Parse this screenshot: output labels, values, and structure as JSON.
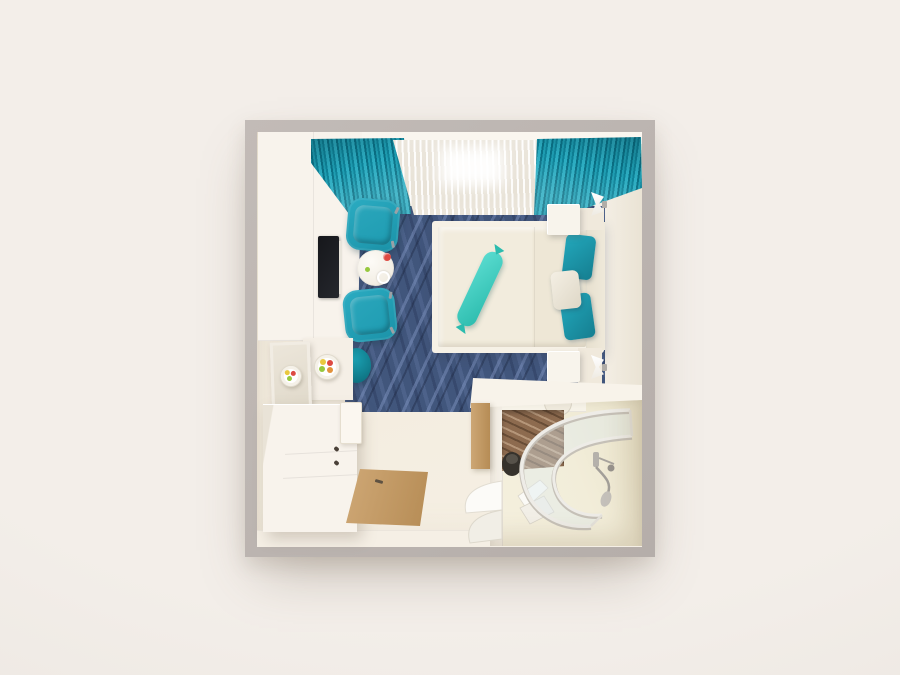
{
  "scene": {
    "type": "3d-interior-render",
    "view": "top-down floor plan",
    "subject": "hotel cabin bedroom with en-suite shower bathroom",
    "text_content": "none"
  },
  "palette": {
    "page-bg": "#f1ece7",
    "wall-outer": "#b5aeaa",
    "wall-outer-light": "#c2bbb7",
    "wall-face": "#eae3d4",
    "pelmet": "#faf6ef",
    "floor": "#f0e9db",
    "floor-light": "#f6f0e4",
    "carpet-base": "#41567c",
    "curtain": "#1e9db2",
    "curtain-dark": "#0a7186",
    "curtain-light": "#2cadc2",
    "sheer": "#f6f2ea",
    "chair": "#2bacc2",
    "chair-deep": "#1b92a8",
    "stool": "#0e7382",
    "stool-light": "#1ba2b4",
    "table": "#f1ece1",
    "bed-base": "#f6f1e6",
    "duvet": "#f2ecdd",
    "headboard": "#efe9da",
    "bolster": "#2cbcae",
    "bolster-light": "#5adcd0",
    "pillow-teal": "#23a9bd",
    "pillow-teal-dark": "#157e90",
    "nightstand": "#f8f4ec",
    "unit-white": "#f8f3ec",
    "tv": "#25272d",
    "knob": "#4a4038",
    "wood": "#cfa876",
    "wood-deep": "#b68c55",
    "bath-wall": "#f2edd9",
    "marble": "#8d6b4f",
    "vanity": "#f8f3ea",
    "metal": "#a8a49e",
    "fruit-red": "#dd4a42",
    "fruit-yellow": "#e9c83e",
    "fruit-green": "#97c83e",
    "fruit-orange": "#e2923b"
  },
  "objects": [
    {
      "name": "room-shell",
      "desc": "square room with thick gray walls viewed from directly above"
    },
    {
      "name": "window-wall",
      "desc": "top wall with white sheer curtain center and teal drapes both sides"
    },
    {
      "name": "wavy-carpet",
      "desc": "navy blue carpet with wavy stripe pattern"
    },
    {
      "name": "wardrobe-desk-unit",
      "desc": "white full-height unit along left wall with TV"
    },
    {
      "name": "tv",
      "desc": "black flat screen on desk"
    },
    {
      "name": "armchair-top",
      "desc": "teal armchair"
    },
    {
      "name": "armchair-bottom",
      "desc": "teal armchair"
    },
    {
      "name": "round-table",
      "items": [
        "red berry dish",
        "white ring",
        "green olive"
      ]
    },
    {
      "name": "teal-stool",
      "desc": "round teal ottoman at carpet edge"
    },
    {
      "name": "leaning-mirror",
      "desc": "framed mirror reflecting fruit plate"
    },
    {
      "name": "fruit-plate",
      "desc": "white plate with yellow, red, green and orange fruit"
    },
    {
      "name": "minibar-cabinet",
      "desc": "white sideboard with two drawers and dark knobs"
    },
    {
      "name": "fridge-door",
      "desc": "small white minibar door"
    },
    {
      "name": "entrance-door",
      "desc": "tan wooden entry door laid open with dark handle"
    },
    {
      "name": "double-bed",
      "desc": "cream duvet with center fold"
    },
    {
      "name": "bolster-cushion",
      "desc": "mint-teal candy-shaped bolster lying diagonally"
    },
    {
      "name": "pillows",
      "desc": "two teal pillows and one white pillow at headboard"
    },
    {
      "name": "headboard",
      "desc": "cream upholstered panel on right wall"
    },
    {
      "name": "nightstand-top",
      "desc": "white bedside cube"
    },
    {
      "name": "nightstand-bottom",
      "desc": "white bedside cube"
    },
    {
      "name": "wall-sconce-top",
      "desc": "white hourglass wall lamp"
    },
    {
      "name": "wall-sconce-bottom",
      "desc": "white hourglass wall lamp"
    },
    {
      "name": "vanity-counter",
      "desc": "white counter spanning bathroom top with recessed sink"
    },
    {
      "name": "bathroom",
      "desc": "en-suite with pale cream walls in bottom-right corner"
    },
    {
      "name": "bathroom-door",
      "desc": "wooden door ajar"
    },
    {
      "name": "hanging-towels",
      "desc": "white towels fanned by the bathroom door"
    },
    {
      "name": "shower-enclosure",
      "desc": "curved glass shower with white frame rails"
    },
    {
      "name": "shower-marble",
      "desc": "brown marble tiled shower corner"
    },
    {
      "name": "toilet",
      "desc": "dark fixture at bathroom left wall"
    },
    {
      "name": "floor-towel",
      "desc": "folded white towel on bathroom floor"
    },
    {
      "name": "shower-handset",
      "desc": "gray hand shower and hose on right wall"
    }
  ]
}
